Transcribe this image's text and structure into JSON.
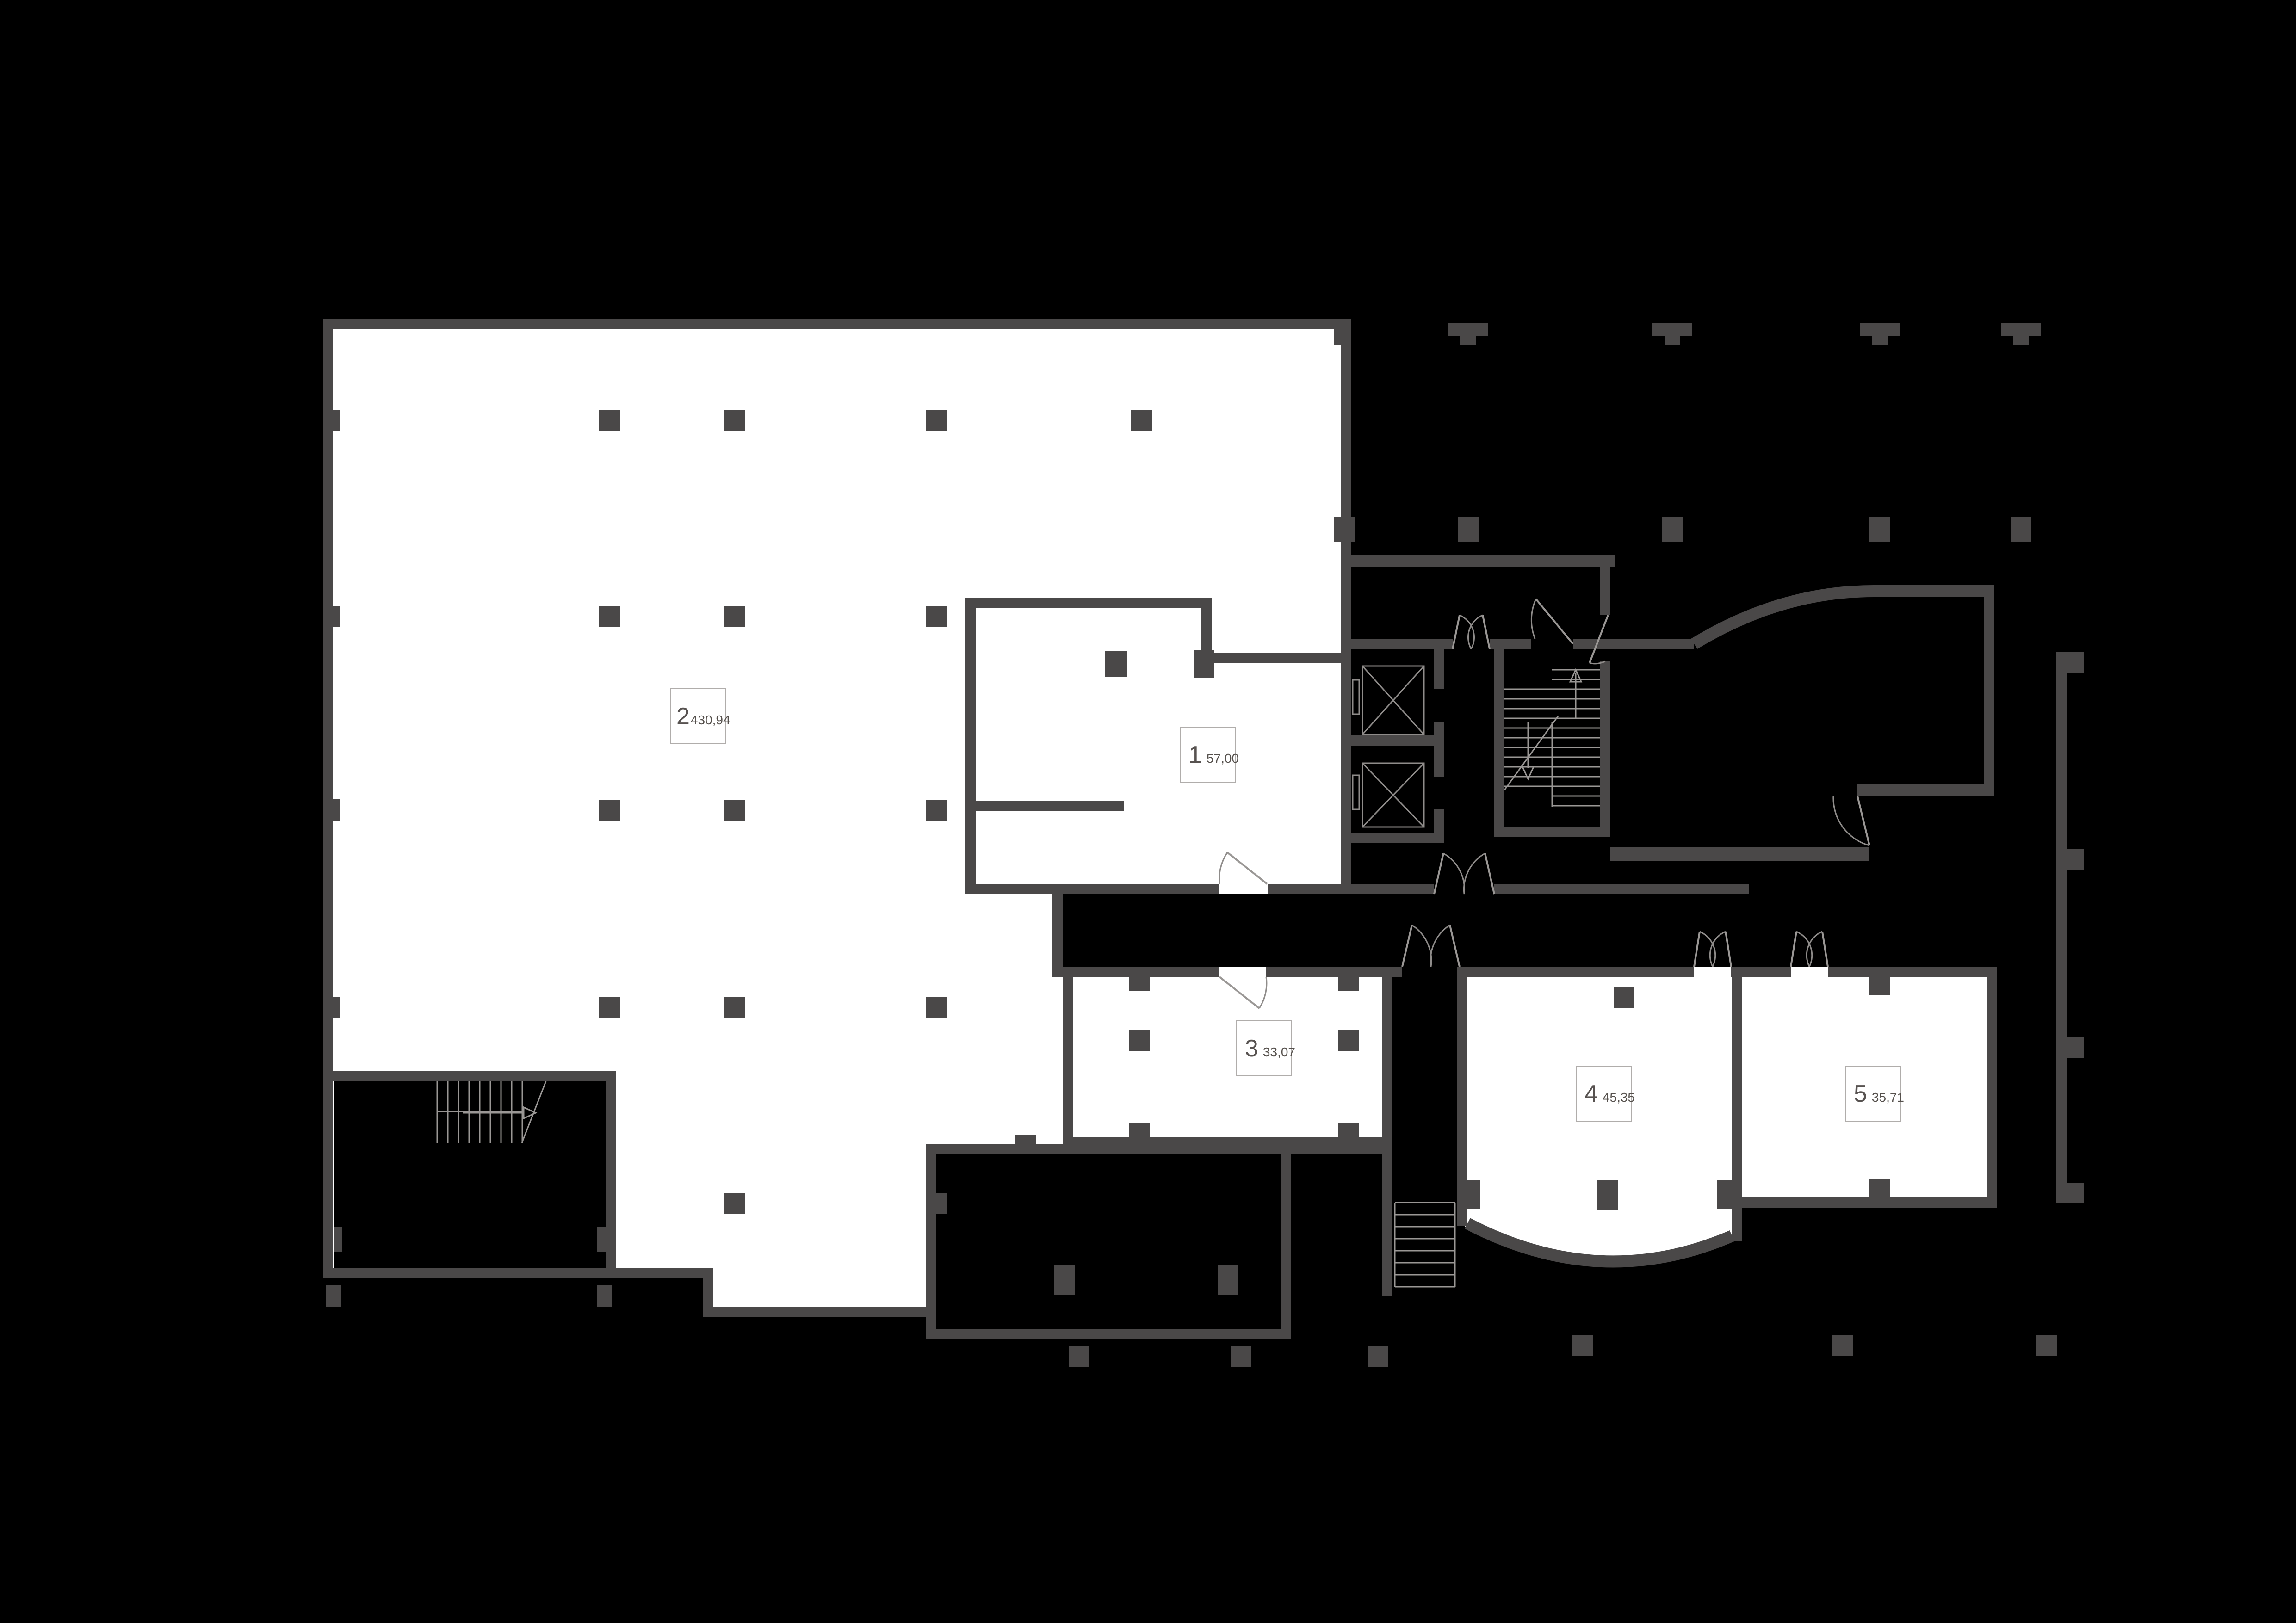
{
  "units": [
    {
      "number": "1",
      "area": "57,00"
    },
    {
      "number": "2",
      "area": "430,94"
    },
    {
      "number": "3",
      "area": "33,07"
    },
    {
      "number": "4",
      "area": "45,35"
    },
    {
      "number": "5",
      "area": "35,71"
    }
  ],
  "colors": {
    "background": "#000000",
    "room_fill": "#ffffff",
    "wall": "#4a4848",
    "detail_line": "#9a9795",
    "label_border": "#b0adab",
    "label_text": "#55504c"
  }
}
